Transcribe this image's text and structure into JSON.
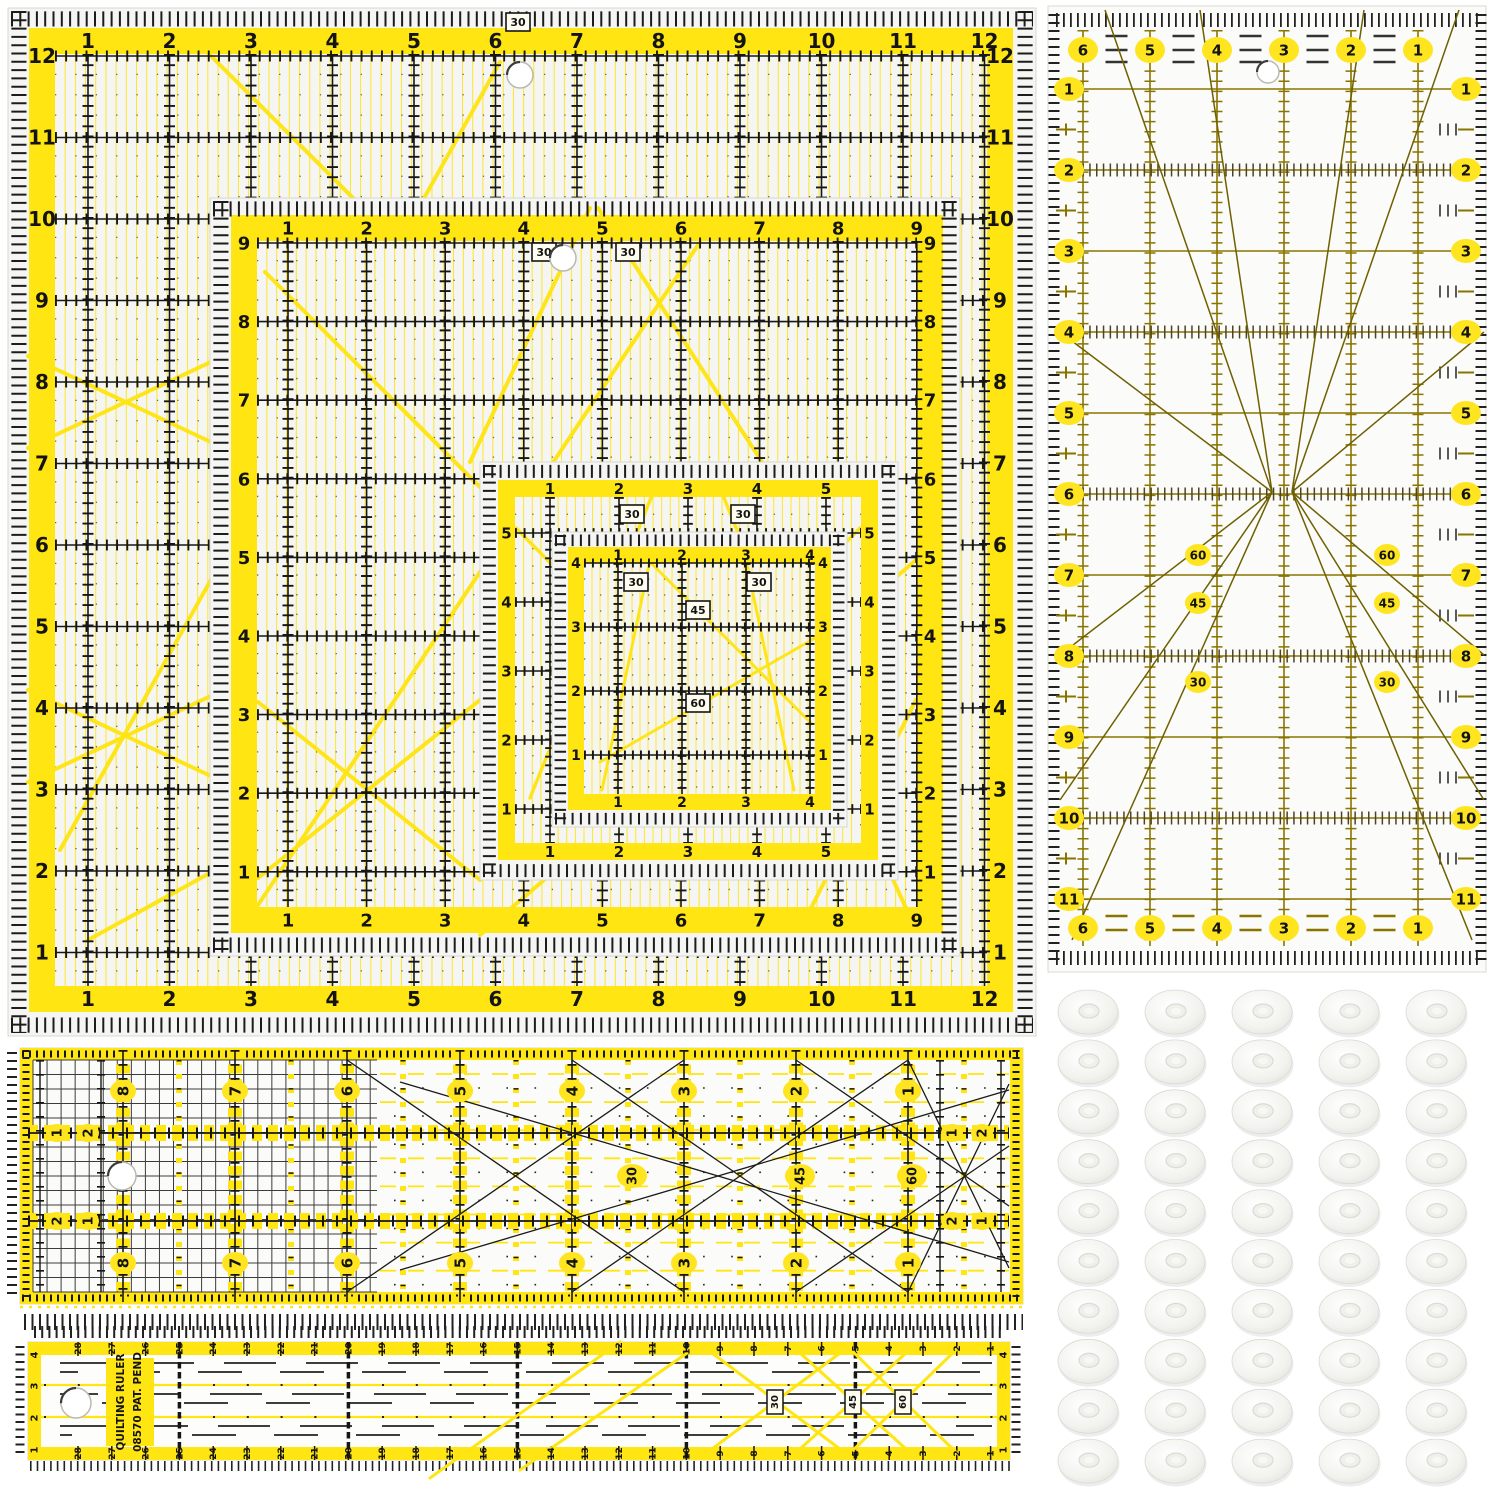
{
  "page": {
    "title": "Quilting ruler set with non-slip adhesive grips",
    "background": "#ffffff"
  },
  "colors": {
    "yellow": "#FFE512",
    "ruler_black": "#161616",
    "acrylic_bg": "#F5F5F3",
    "olive": "#8A7400",
    "olive_dark": "#6F6000",
    "badge_yellow": "#FFE520",
    "grip_edge": "#DADAD5",
    "white": "#FFFFFF"
  },
  "square_rulers": [
    {
      "id": "square-ruler-12-inch",
      "top": [
        "1",
        "2",
        "3",
        "4",
        "5",
        "6",
        "7",
        "8",
        "9",
        "10",
        "11",
        "12"
      ],
      "bottom": [
        "1",
        "2",
        "3",
        "4",
        "5",
        "6",
        "7",
        "8",
        "9",
        "10",
        "11",
        "12"
      ],
      "left": [
        "12",
        "11",
        "10",
        "9",
        "8",
        "7",
        "6",
        "5",
        "4",
        "3",
        "2",
        "1"
      ],
      "right": [
        "12",
        "11",
        "10",
        "9",
        "8",
        "7",
        "6",
        "5",
        "4",
        "3",
        "2",
        "1"
      ],
      "angle_boxes": [
        "30"
      ]
    },
    {
      "id": "square-ruler-9-inch",
      "top": [
        "1",
        "2",
        "3",
        "4",
        "5",
        "6",
        "7",
        "8",
        "9"
      ],
      "bottom": [
        "1",
        "2",
        "3",
        "4",
        "5",
        "6",
        "7",
        "8",
        "9"
      ],
      "left": [
        "9",
        "8",
        "7",
        "6",
        "5",
        "4",
        "3",
        "2",
        "1"
      ],
      "right": [
        "9",
        "8",
        "7",
        "6",
        "5",
        "4",
        "3",
        "2",
        "1"
      ],
      "angle_boxes": [
        "30",
        "30"
      ]
    },
    {
      "id": "square-ruler-6-inch",
      "top": [
        "1",
        "2",
        "3",
        "4",
        "5"
      ],
      "bottom": [
        "1",
        "2",
        "3",
        "4",
        "5"
      ],
      "left": [
        "5",
        "4",
        "3",
        "2",
        "1"
      ],
      "right": [
        "5",
        "4",
        "3",
        "2",
        "1"
      ],
      "angle_boxes": [
        "30",
        "30"
      ]
    },
    {
      "id": "square-ruler-4-inch",
      "top": [
        "1",
        "2",
        "3",
        "4"
      ],
      "bottom": [
        "1",
        "2",
        "3",
        "4"
      ],
      "left": [
        "4",
        "3",
        "2",
        "1"
      ],
      "right": [
        "4",
        "3",
        "2",
        "1"
      ],
      "angle_boxes": [
        "30",
        "30",
        "45",
        "60"
      ]
    }
  ],
  "grid_ruler": {
    "id": "rect-ruler-6x12-inch",
    "top": [
      "6",
      "5",
      "4",
      "3",
      "2",
      "1"
    ],
    "bottom": [
      "6",
      "5",
      "4",
      "3",
      "2",
      "1"
    ],
    "left": [
      "1",
      "2",
      "3",
      "4",
      "5",
      "6",
      "7",
      "8",
      "9",
      "10",
      "11"
    ],
    "right": [
      "1",
      "2",
      "3",
      "4",
      "5",
      "6",
      "7",
      "8",
      "9",
      "10",
      "11"
    ],
    "angle_labels_left": [
      "60",
      "45",
      "30"
    ],
    "angle_labels_right": [
      "60",
      "45",
      "30"
    ]
  },
  "strip_ruler": {
    "id": "strip-ruler-wide",
    "upper": [
      "8",
      "7",
      "6",
      "5",
      "4",
      "3",
      "2",
      "1"
    ],
    "lower": [
      "8",
      "7",
      "6",
      "5",
      "4",
      "3",
      "2",
      "1"
    ],
    "left_end_upper": [
      "1",
      "2"
    ],
    "left_end_lower": [
      "2",
      "1"
    ],
    "right_end_upper": [
      "1",
      "2"
    ],
    "right_end_lower": [
      "2",
      "1"
    ],
    "angle_labels": [
      "30",
      "45",
      "60"
    ]
  },
  "long_ruler": {
    "id": "long-ruler-30",
    "scale": [
      "28",
      "27",
      "26",
      "25",
      "24",
      "23",
      "22",
      "21",
      "20",
      "19",
      "18",
      "17",
      "16",
      "15",
      "14",
      "13",
      "12",
      "11",
      "10",
      "9",
      "8",
      "7",
      "6",
      "5",
      "4",
      "3",
      "2",
      "1"
    ],
    "edge": [
      "4",
      "3",
      "2",
      "1"
    ],
    "angle_boxes": [
      "30",
      "45",
      "60"
    ],
    "brand_line1": "QUILTING RULER",
    "brand_line2": "08570  PAT. PEND"
  },
  "grips": {
    "rows": 10,
    "cols": 5,
    "label": "non-slip adhesive grip"
  }
}
